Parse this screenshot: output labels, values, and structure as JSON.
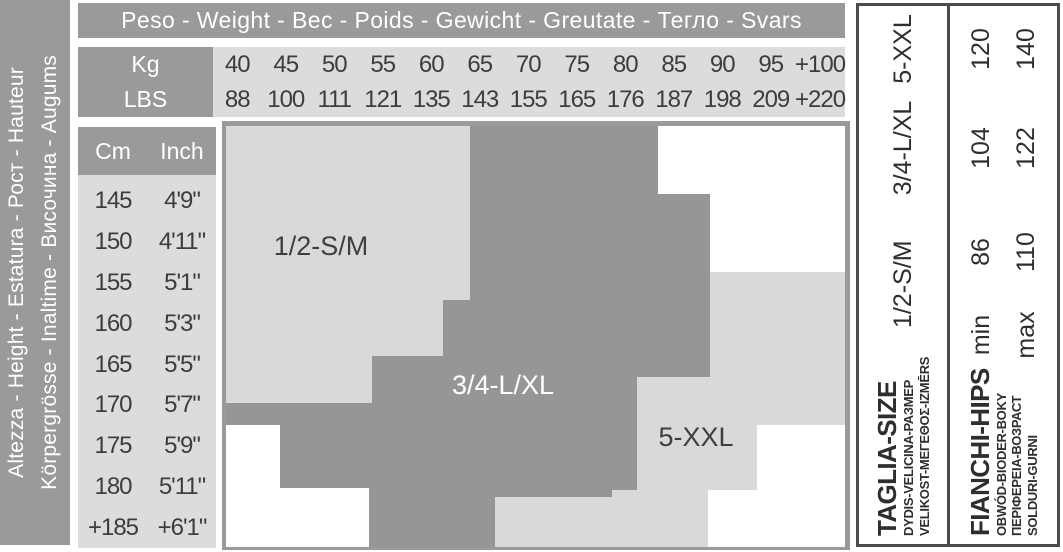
{
  "header": {
    "title": "Peso - Weight - Вес - Poids - Gewicht - Greutate - Тегло - Svars",
    "kg_label": "Kg",
    "lbs_label": "LBS",
    "kg_values": [
      "40",
      "45",
      "50",
      "55",
      "60",
      "65",
      "70",
      "75",
      "80",
      "85",
      "90",
      "95",
      "+100"
    ],
    "lbs_values": [
      "88",
      "100",
      "111",
      "121",
      "135",
      "143",
      "155",
      "165",
      "176",
      "187",
      "198",
      "209",
      "+220"
    ]
  },
  "height_band": {
    "line1": "Altezza - Height - Estatura - Рост - Hauteur",
    "line2": "Körpergrösse - Inaltime - Височина - Augums"
  },
  "height_table": {
    "cm_label": "Cm",
    "inch_label": "Inch",
    "rows": [
      {
        "cm": "145",
        "inch": "4'9\""
      },
      {
        "cm": "150",
        "inch": "4'11\""
      },
      {
        "cm": "155",
        "inch": "5'1\""
      },
      {
        "cm": "160",
        "inch": "5'3\""
      },
      {
        "cm": "165",
        "inch": "5'5\""
      },
      {
        "cm": "170",
        "inch": "5'7\""
      },
      {
        "cm": "175",
        "inch": "5'9\""
      },
      {
        "cm": "180",
        "inch": "5'11\""
      },
      {
        "cm": "+185",
        "inch": "+6'1\""
      }
    ]
  },
  "chart_data": {
    "type": "zone-map",
    "x_axis": {
      "units": [
        "Kg",
        "LBS"
      ],
      "kg": [
        40,
        45,
        50,
        55,
        60,
        65,
        70,
        75,
        80,
        85,
        90,
        95,
        "+100"
      ],
      "lbs": [
        88,
        100,
        111,
        121,
        135,
        143,
        155,
        165,
        176,
        187,
        198,
        209,
        "+220"
      ]
    },
    "y_axis": {
      "cm": [
        145,
        150,
        155,
        160,
        165,
        170,
        175,
        180,
        "+185"
      ],
      "inch": [
        "4'9\"",
        "4'11\"",
        "5'1\"",
        "5'3\"",
        "5'5\"",
        "5'7\"",
        "5'9\"",
        "5'11\"",
        "+6'1\""
      ]
    },
    "colors": {
      "zone_light": "#d9d9d9",
      "zone_dark": "#969696",
      "empty": "#ffffff",
      "border": "#9a9a9a"
    },
    "zones": [
      {
        "label": "1/2-S/M",
        "fill": "#d9d9d9",
        "text_color": "#3f3f3f",
        "points": "4,5 248,5 248,179 221,179 221,235 150,235 150,282 4,282",
        "label_x": 99,
        "label_y": 125
      },
      {
        "label": "3/4-L/XL",
        "fill": "#969696",
        "text_color": "#ffffff",
        "points": "248,5 436,5 436,73 488,73 488,256 415,256 415,369 390,369 390,376 273,376 273,426 147,426 147,367 58,367 58,304 4,304 4,282 150,282 150,235 221,235 221,179 248,179",
        "label_x": 281,
        "label_y": 264
      },
      {
        "label": "5-XXL",
        "fill": "#d9d9d9",
        "text_color": "#3f3f3f",
        "points": "488,151 623,151 623,304 535,304 535,369 486,369 486,426 273,426 273,376 390,376 390,369 415,369 415,256 488,256",
        "label_x": 474,
        "label_y": 316
      }
    ]
  },
  "side_panel": {
    "size_header_lines": [
      "TAGLIA-SIZE",
      "DYDIS-VELICINA-РАЗМЕР",
      "VELIKOST-ΜΕΓΕΘΟΣ-IZMĒRS"
    ],
    "hips_header_lines": [
      "FIANCHI-HIPS",
      "OBWÓD-BIODER-BOKY",
      "ПЕРІФЕРЕІА-ВОЗРАСТ",
      "SOLDURI-GURNI"
    ],
    "min_label": "min",
    "max_label": "max",
    "entries": [
      {
        "size": "1/2-S/M",
        "hips_min": "86",
        "hips_max": "110"
      },
      {
        "size": "3/4-L/XL",
        "hips_min": "104",
        "hips_max": "122"
      },
      {
        "size": "5-XXL",
        "hips_min": "120",
        "hips_max": "140"
      }
    ]
  }
}
